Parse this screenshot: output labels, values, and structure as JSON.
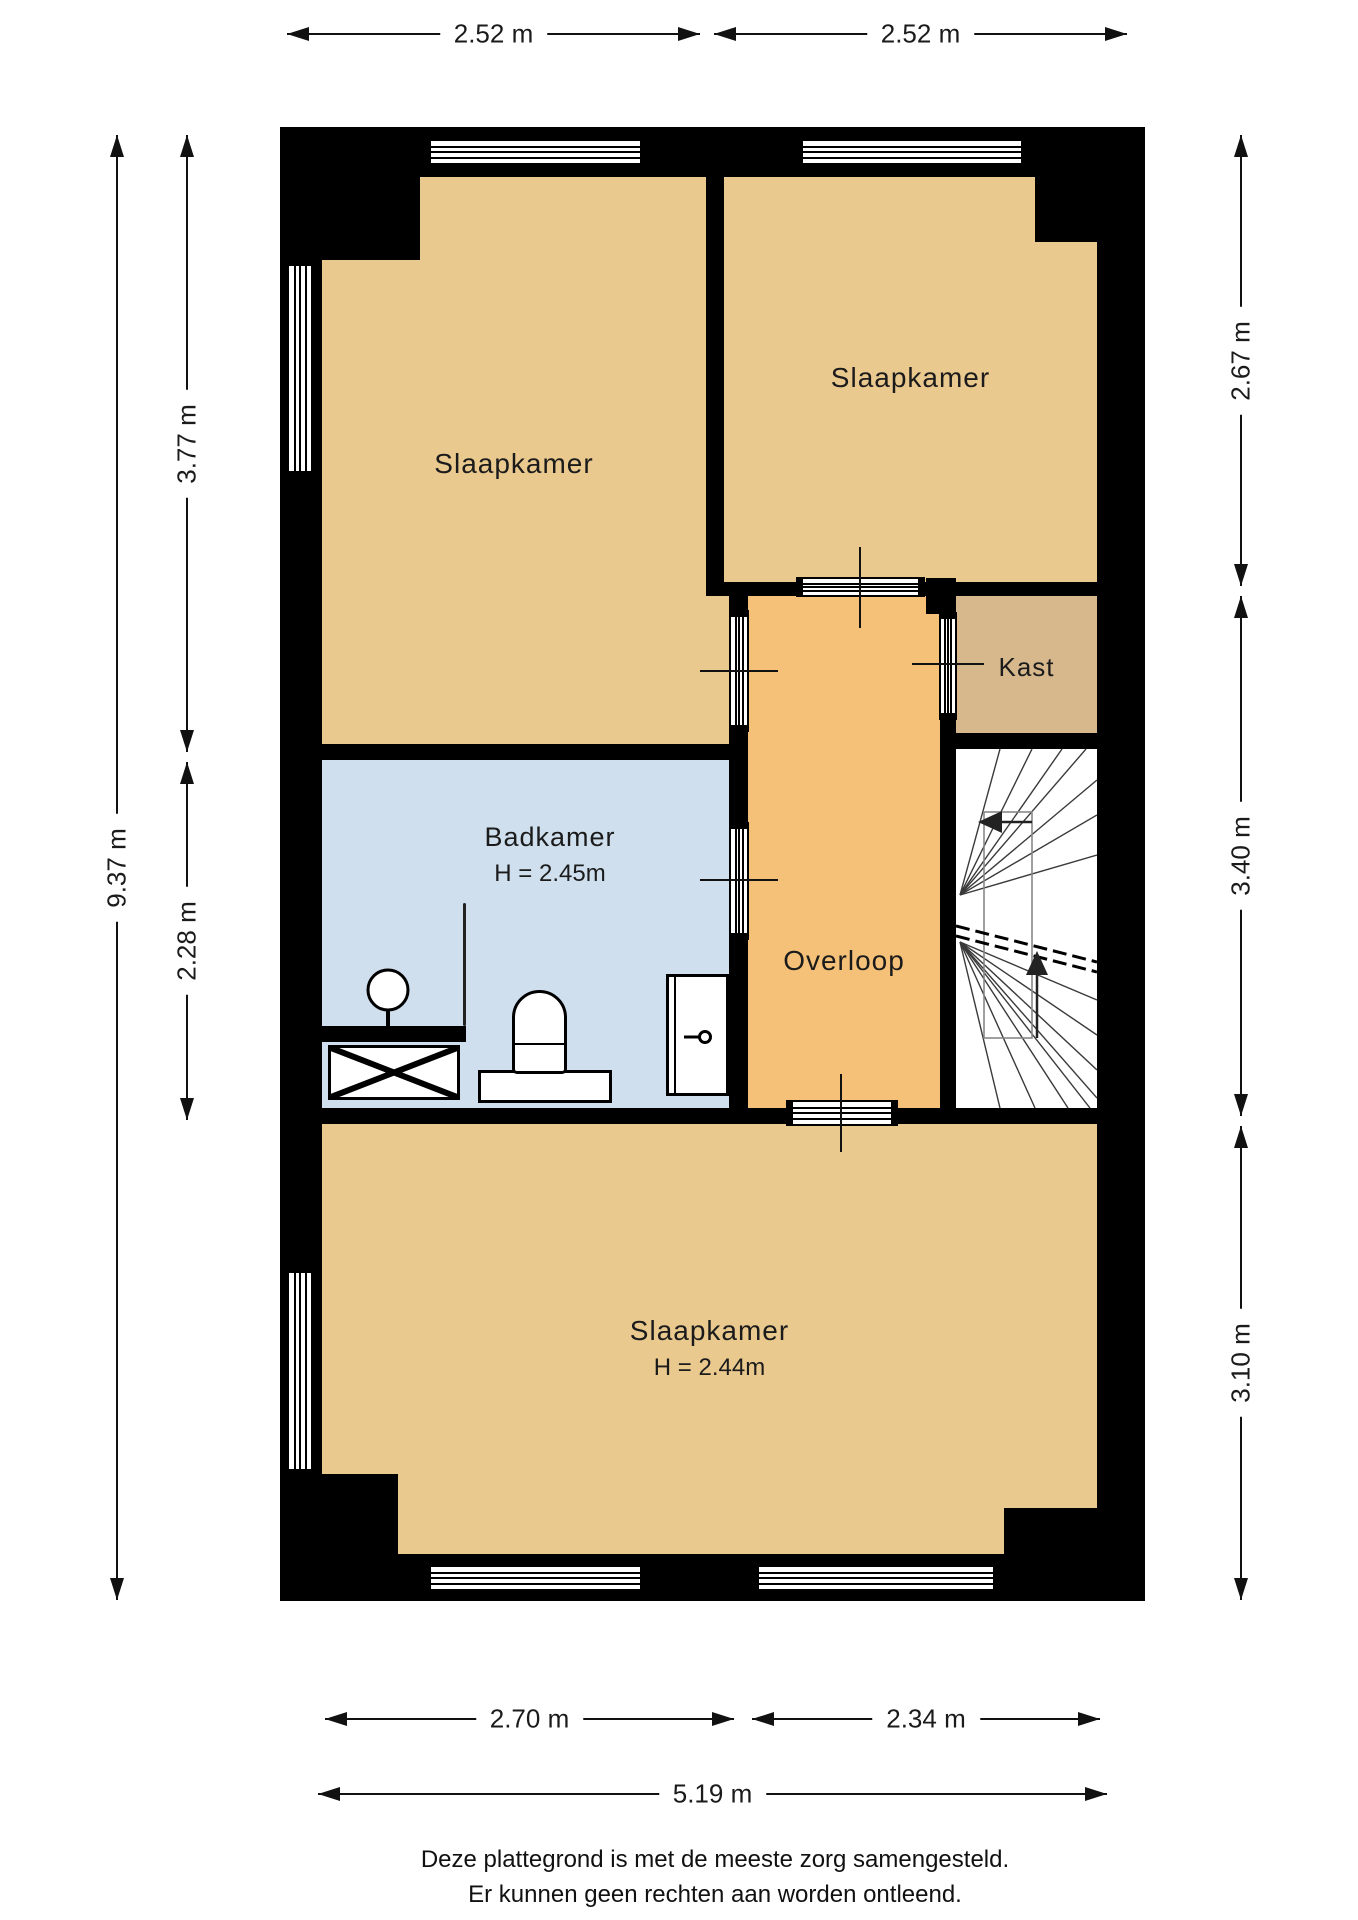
{
  "plan": {
    "rooms": {
      "bedroom_top_left": {
        "label": "Slaapkamer"
      },
      "bedroom_top_right": {
        "label": "Slaapkamer"
      },
      "closet": {
        "label": "Kast"
      },
      "landing": {
        "label": "Overloop"
      },
      "bathroom": {
        "label": "Badkamer",
        "ceiling_height": "H = 2.45m"
      },
      "bedroom_bottom": {
        "label": "Slaapkamer",
        "ceiling_height": "H = 2.44m"
      }
    },
    "dimensions": {
      "top": [
        "2.52 m",
        "2.52 m"
      ],
      "left_total": "9.37 m",
      "left_segments": [
        "3.77 m",
        "2.28 m"
      ],
      "right_segments": [
        "2.67 m",
        "3.40 m",
        "3.10 m"
      ],
      "bottom_segments": [
        "2.70 m",
        "2.34 m"
      ],
      "bottom_total": "5.19 m"
    },
    "disclaimer": {
      "line1": "Deze plattegrond is met de meeste zorg samengesteld.",
      "line2": "Er kunnen geen rechten aan worden ontleend."
    },
    "colors": {
      "wall": "#000000",
      "room_fill": "#eac98f",
      "landing_fill": "#f5c178",
      "closet_fill": "#d6b88c",
      "bathroom_fill": "#cfdfee"
    }
  }
}
